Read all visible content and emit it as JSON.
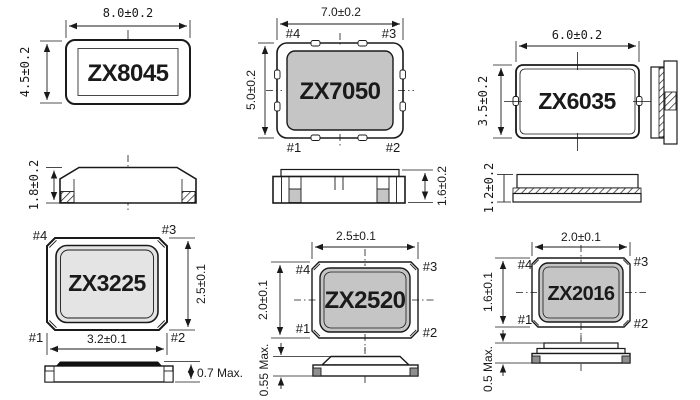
{
  "packages": {
    "zx8045": {
      "name": "ZX8045",
      "width": "8.0±0.2",
      "height": "4.5±0.2",
      "thickness": "1.8±0.2"
    },
    "zx7050": {
      "name": "ZX7050",
      "width": "7.0±0.2",
      "height": "5.0±0.2",
      "thickness": "1.6±0.2",
      "pad1": "#1",
      "pad2": "#2",
      "pad3": "#3",
      "pad4": "#4"
    },
    "zx6035": {
      "name": "ZX6035",
      "width": "6.0±0.2",
      "height": "3.5±0.2",
      "thickness": "1.2±0.2"
    },
    "zx3225": {
      "name": "ZX3225",
      "width": "3.2±0.1",
      "height": "2.5±0.1",
      "thickness": "0.7 Max.",
      "pad1": "#1",
      "pad2": "#2",
      "pad3": "#3",
      "pad4": "#4"
    },
    "zx2520": {
      "name": "ZX2520",
      "width": "2.5±0.1",
      "height": "2.0±0.1",
      "thickness": "0.55 Max.",
      "pad1": "#1",
      "pad2": "#2",
      "pad3": "#3",
      "pad4": "#4"
    },
    "zx2016": {
      "name": "ZX2016",
      "width": "2.0±0.1",
      "height": "1.6±0.1",
      "thickness": "0.5 Max.",
      "pad1": "#1",
      "pad2": "#2",
      "pad3": "#3",
      "pad4": "#4"
    }
  },
  "colors": {
    "line": "#1a1a1a",
    "body_gray": "#c5c5c5",
    "body_light": "#e4e4e4",
    "pad_dark": "#8f8f8f",
    "lid_black": "#111111",
    "background": "#ffffff"
  }
}
